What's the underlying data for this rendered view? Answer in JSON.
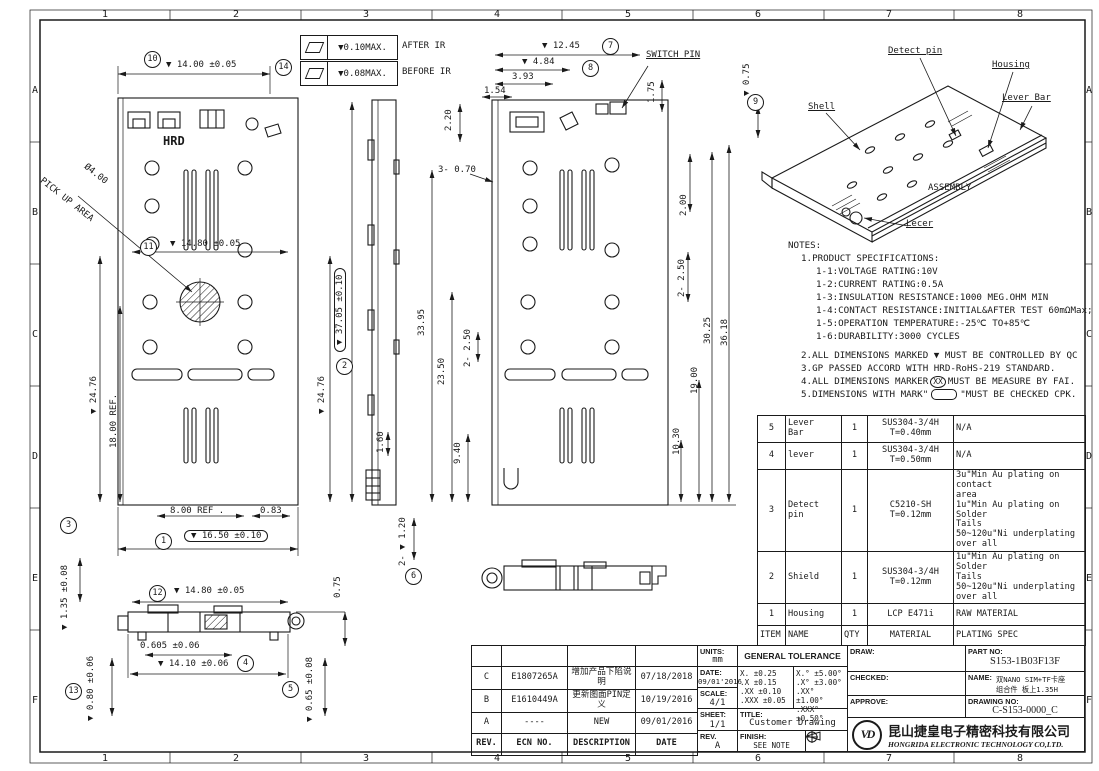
{
  "border": {
    "cols": [
      "1",
      "2",
      "3",
      "4",
      "5",
      "6",
      "7",
      "8"
    ],
    "rows": [
      "A",
      "B",
      "C",
      "D",
      "E",
      "F"
    ]
  },
  "flatness_callouts": {
    "after": {
      "value": "▼0.10MAX.",
      "note": "AFTER IR"
    },
    "before": {
      "value": "▼0.08MAX.",
      "note": "BEFORE IR"
    }
  },
  "balloons": {
    "n1": "1",
    "n2": "2",
    "n3": "3",
    "n4": "4",
    "n5": "5",
    "n6": "6",
    "n7": "7",
    "n8": "8",
    "n9": "9",
    "n10": "10",
    "n11": "11",
    "n12": "12",
    "n13": "13",
    "n14": "14"
  },
  "dims": {
    "d14_00": "▼ 14.00 ±0.05",
    "d14_80_top": "▼ 14.80 ±0.05",
    "d24_76_left": "▼ 24.76",
    "d18_00": "18.00 REF.",
    "d8_00": "8.00 REF .",
    "d0_83": "0.83",
    "d16_50": "▼ 16.50 ±0.10",
    "d1_35": "▼ 1.35 ±0.08",
    "d37_05": "▼ 37.05 ±0.10",
    "d24_76_mid": "▼ 24.76",
    "d1_60": "1.60",
    "d2_20": "2.20",
    "d3_0_70": "3- 0.70",
    "d33_95": "33.95",
    "d23_50": "23.50",
    "d2_2_50_l": "2- 2.50",
    "d9_40": "9.40",
    "d2_1_20": "2- ▼ 1.20",
    "d12_45": "▼ 12.45",
    "d4_84": "▼ 4.84",
    "d3_93": "3.93",
    "d1_54": "1.54",
    "d1_75": "1.75",
    "d0_75_top": "▼ 0.75",
    "d2_00": "2.00",
    "d2_2_50_r": "2- 2.50",
    "d30_25": "30.25",
    "d36_18": "36.18",
    "d19_00": "19.00",
    "d10_30": "10.30",
    "d14_80_bot": "▼ 14.80 ±0.05",
    "d0_75_bot": "0.75",
    "d0_605": "0.605 ±0.06",
    "d14_10": "▼ 14.10 ±0.06",
    "d0_80": "▼ 0.80 ±0.06",
    "d0_65": "▼ 0.65 ±0.08"
  },
  "labels": {
    "switch_pin": "SWITCH PIN",
    "hrd": "HRD",
    "pick_dia": "Ø4.00",
    "pick_area": "PICK UP AREA",
    "detect_pin": "Detect pin",
    "housing": "Housing",
    "lever_bar": "Lever Bar",
    "shell": "Shell",
    "assembly": "ASSEMBLY",
    "lecer": "Lecer"
  },
  "notes": {
    "title": "NOTES:",
    "spec_lines": [
      "1.PRODUCT SPECIFICATIONS:",
      "1-1:VOLTAGE RATING:10V",
      "1-2:CURRENT RATING:0.5A",
      "1-3:INSULATION RESISTANCE:1000 MEG.OHM MIN",
      "1-4:CONTACT RESISTANCE:INITIAL&AFTER TEST 60mΩMax;",
      "1-5:OPERATION TEMPERATURE:-25℃ TO+85℃",
      "1-6:DURABILITY:3000 CYCLES"
    ],
    "note2": "2.ALL DIMENSIONS MARKED ▼ MUST BE CONTROLLED BY QC",
    "note3": "3.GP PASSED ACCORD WITH HRD-RoHS-219 STANDARD.",
    "note4_prefix": "4.ALL DIMENSIONS MARKER",
    "note4_circle": "XX",
    "note4_suffix": "MUST BE MEASURE BY FAI.",
    "note5_prefix": "5.DIMENSIONS WITH MARK\"",
    "note5_suffix": "\"MUST BE CHECKED CPK."
  },
  "parts_table": {
    "headers": [
      "ITEM",
      "NAME",
      "QTY",
      "MATERIAL",
      "PLATING SPEC"
    ],
    "rows": [
      {
        "item": "5",
        "name": "Lever\nBar",
        "qty": "1",
        "material": "SUS304-3/4H\nT=0.40mm",
        "plating": "N/A"
      },
      {
        "item": "4",
        "name": "lever",
        "qty": "1",
        "material": "SUS304-3/4H\nT=0.50mm",
        "plating": "N/A"
      },
      {
        "item": "3",
        "name": "Detect\npin",
        "qty": "1",
        "material": "C5210-SH\nT=0.12mm",
        "plating": "3u\"Min Au plating on contact\narea\n1u\"Min Au plating on Solder\nTails\n50~120u\"Ni underplating over all"
      },
      {
        "item": "2",
        "name": "Shield",
        "qty": "1",
        "material": "SUS304-3/4H\nT=0.12mm",
        "plating": "1u\"Min Au plating on Solder\nTails\n50~120u\"Ni underplating over all"
      },
      {
        "item": "1",
        "name": "Housing",
        "qty": "1",
        "material": "LCP E471i",
        "plating": "RAW MATERIAL"
      }
    ]
  },
  "rev_table": {
    "headers": [
      "REV.",
      "ECN NO.",
      "DESCRIPTION",
      "DATE"
    ],
    "rows": [
      {
        "rev": "C",
        "ecn": "E1807265A",
        "desc": "增加产品下陷说明",
        "date": "07/18/2018"
      },
      {
        "rev": "B",
        "ecn": "E1610449A",
        "desc": "更新图面PIN定义",
        "date": "10/19/2016"
      },
      {
        "rev": "A",
        "ecn": "----",
        "desc": "NEW",
        "date": "09/01/2016"
      }
    ]
  },
  "title_block": {
    "units_label": "UNITS:",
    "units_value": "mm",
    "general_tolerance": "GENERAL TOLERANCE",
    "date_label": "DATE:",
    "date_value": "09/01'2016",
    "scale_label": "SCALE:",
    "scale_value": "4/1",
    "sheet_label": "SHEET:",
    "sheet_value": "1/1",
    "rev_label": "REV.",
    "rev_value": "A",
    "title_label": "TITLE:",
    "title_value": "Customer Drawing",
    "finish_label": "FINISH:",
    "finish_value": "SEE NOTE",
    "tol_linear": "X.   ±0.25\n.X   ±0.15\n.XX  ±0.10\n.XXX ±0.05",
    "tol_angular": "X.°   ±5.00°\n.X°   ±3.00°\n.XX°  ±1.00°\n.XXX° ±0.50°",
    "draw_label": "DRAW:",
    "checked_label": "CHECKED:",
    "approve_label": "APPROVE:",
    "part_no_label": "PART NO:",
    "part_no": "S153-1B03F13F",
    "name_label": "NAME:",
    "name_value": "双NANO SIM+TF卡座\n组合件 板上1.35H",
    "drawing_no_label": "DRAWING NO:",
    "drawing_no": "C-S153-0000_C",
    "logo_text": "VD",
    "company_cn": "昆山捷皇电子精密科技有限公司",
    "company_en": "HONGRIDA ELECTRONIC TECHNOLOGY CO,LTD."
  }
}
